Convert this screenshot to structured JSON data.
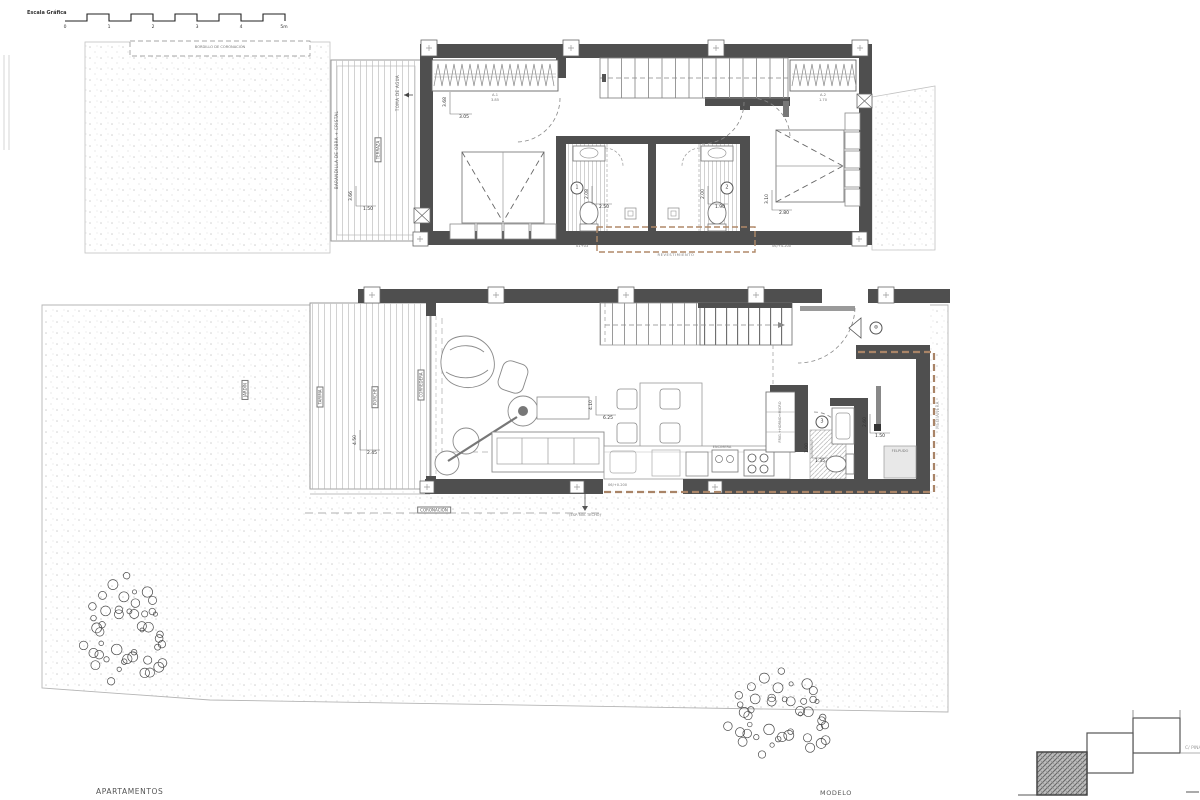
{
  "scale_bar": {
    "label": "Escala Gráfica",
    "ticks": [
      "0",
      "1",
      "2",
      "3",
      "4",
      "5m"
    ]
  },
  "upper_plan": {
    "pergola_label": "BORDILLO DE CORONACIÓN",
    "water_tap_label": "TOMA DE AGUA",
    "railing_label": "BARANDILLA DE OBRA + CRISTAL",
    "terrace_label": "TERRAZA",
    "terrace_dim_v": "3.66",
    "terrace_dim_h": "1.50",
    "wardrobe_1": {
      "name": "A-1",
      "width": "3.85"
    },
    "wardrobe_2": {
      "name": "A-2",
      "width": "1.70"
    },
    "bedroom_1_dim_v": "3.68",
    "bedroom_1_dim_h": "3.05",
    "bedroom_2_dim_v": "3.10",
    "bedroom_2_dim_h": "2.80",
    "bath_1": {
      "number": "1",
      "dim_v": "2.08",
      "dim_h": "2.50"
    },
    "bath_2": {
      "number": "2",
      "dim_v": "2.00",
      "dim_h": "1.90"
    },
    "note_left": "01+03",
    "level_note": "06/+4.200",
    "cladding_label": "REVESTIMIENTO"
  },
  "ground_plan": {
    "garden_label": "JARDÍN",
    "deck_label": "TARIMA",
    "porch_label": "PORCHE",
    "slider_label": "CORREDERA",
    "deck_dim_v": "4.50",
    "deck_dim_h": "2.45",
    "living_dim_v": "4.10",
    "living_dim_h": "6.25",
    "counter_label": "ENCIMERA",
    "tall_units_label": "FRIG.+HORNO+MICRO",
    "bath_3": {
      "number": "3",
      "dim_v": "1.00",
      "dim_h": "1.35"
    },
    "hall_dim_v": "2.60",
    "hall_dim_h": "1.50",
    "doormat_label": "FELPUDO",
    "entry_symbol": "⊛",
    "level_note": "06/+0.200",
    "coping_label": "CORONACIÓN",
    "ceiling_note": "(ESP. NIV. TECHO)",
    "boundary_label": "MEDIANERA"
  },
  "footer": {
    "project_label": "APARTAMENTOS",
    "model_label": "MODELO"
  },
  "key_plan": {
    "street_label": "C/ PINA"
  }
}
